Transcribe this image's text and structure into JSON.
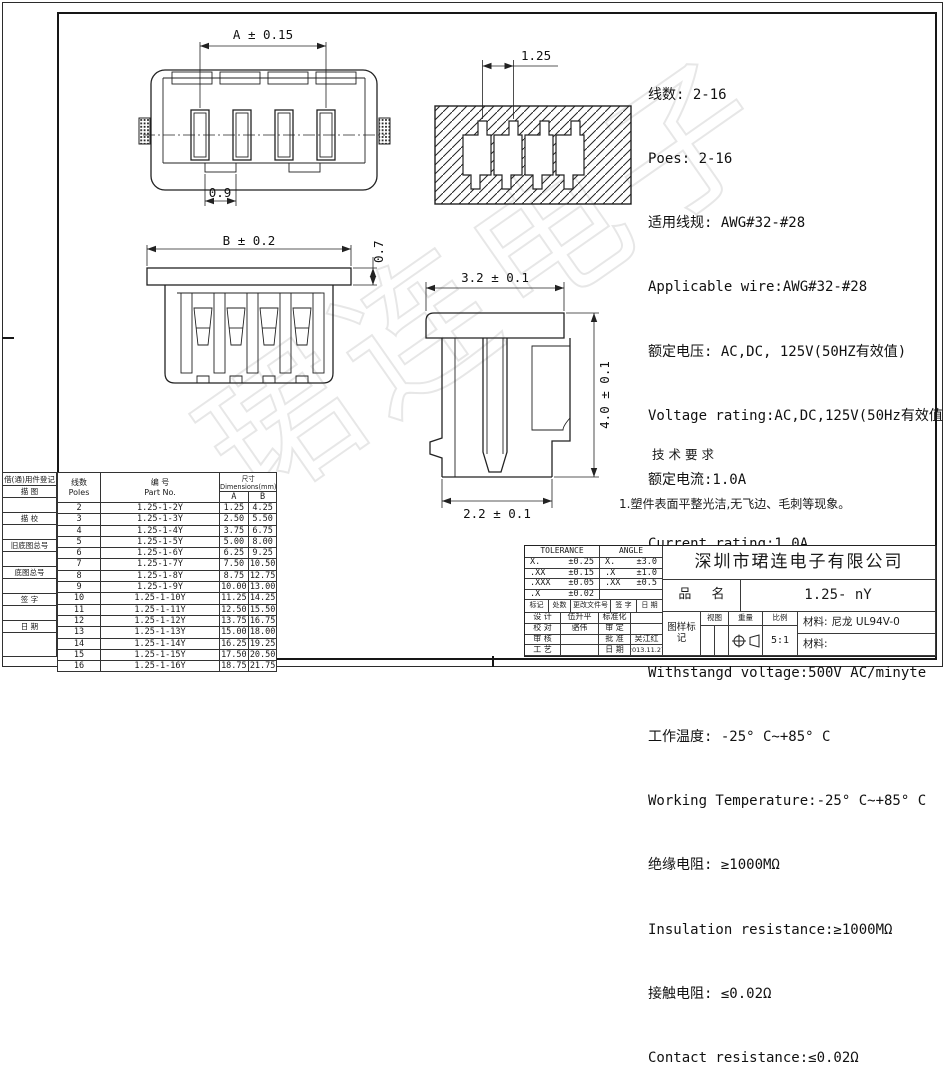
{
  "sheet": {
    "company": "深圳市珺连电子有限公司",
    "part_name_label": "品 名",
    "part_name": "1.25- nY",
    "scale": "5:1",
    "material1_label": "材料:",
    "material1_value": "尼龙 UL94V-0",
    "material2_label": "材料:",
    "watermark": "珺连电子"
  },
  "specs": {
    "lines": [
      "线数: 2-16",
      "Poes: 2-16",
      "适用线规: AWG#32-#28",
      "Applicable wire:AWG#32-#28",
      "额定电压: AC,DC, 125V(50HZ有效值)",
      "Voltage rating:AC,DC,125V(50Hz有效值)",
      "额定电流:1.0A",
      "Current rating:1.0A",
      "耐压值: 500V AC/minyte",
      "Withstangd voltage:500V AC/minyte",
      "工作温度: -25° C~+85° C",
      "Working Temperature:-25° C~+85° C",
      "绝缘电阻: ≥1000MΩ",
      "Insulation resistance:≥1000MΩ",
      "接触电阻: ≤0.02Ω",
      "Contact resistance:≤0.02Ω"
    ]
  },
  "tech": {
    "title": "技术要求",
    "items": [
      "1.塑件表面平整光洁,无飞边、毛刺等现象。",
      "2.未注尺寸公差按SJ1372-78中3级执行。",
      "3.相同规格的产品不同厂家应能互换。"
    ]
  },
  "dims": {
    "a": "A ± 0.15",
    "slot": "0.9",
    "pitch": "1.25",
    "b": "B ± 0.2",
    "flange": "0.7",
    "top_w": "3.2 ± 0.1",
    "height": "4.0 ± 0.1",
    "bottom_w": "2.2 ± 0.1"
  },
  "margin": {
    "header": "借(通)用件登记",
    "sections": [
      "描 图",
      "描 校",
      "旧底图总号",
      "底图总号",
      "签 字",
      "日 期"
    ]
  },
  "parts_table": {
    "col_poles_cn": "线数",
    "col_poles_en": "Poles",
    "col_part_cn": "编 号",
    "col_part_en": "Part No.",
    "col_dim": "尺寸Dimensions(mm)",
    "col_a": "A",
    "col_b": "B",
    "rows": [
      {
        "poles": "2",
        "part": "1.25-1-2Y",
        "a": "1.25",
        "b": "4.25"
      },
      {
        "poles": "3",
        "part": "1.25-1-3Y",
        "a": "2.50",
        "b": "5.50"
      },
      {
        "poles": "4",
        "part": "1.25-1-4Y",
        "a": "3.75",
        "b": "6.75"
      },
      {
        "poles": "5",
        "part": "1.25-1-5Y",
        "a": "5.00",
        "b": "8.00"
      },
      {
        "poles": "6",
        "part": "1.25-1-6Y",
        "a": "6.25",
        "b": "9.25"
      },
      {
        "poles": "7",
        "part": "1.25-1-7Y",
        "a": "7.50",
        "b": "10.50"
      },
      {
        "poles": "8",
        "part": "1.25-1-8Y",
        "a": "8.75",
        "b": "12.75"
      },
      {
        "poles": "9",
        "part": "1.25-1-9Y",
        "a": "10.00",
        "b": "13.00"
      },
      {
        "poles": "10",
        "part": "1.25-1-10Y",
        "a": "11.25",
        "b": "14.25"
      },
      {
        "poles": "11",
        "part": "1.25-1-11Y",
        "a": "12.50",
        "b": "15.50"
      },
      {
        "poles": "12",
        "part": "1.25-1-12Y",
        "a": "13.75",
        "b": "16.75"
      },
      {
        "poles": "13",
        "part": "1.25-1-13Y",
        "a": "15.00",
        "b": "18.00"
      },
      {
        "poles": "14",
        "part": "1.25-1-14Y",
        "a": "16.25",
        "b": "19.25"
      },
      {
        "poles": "15",
        "part": "1.25-1-15Y",
        "a": "17.50",
        "b": "20.50"
      },
      {
        "poles": "16",
        "part": "1.25-1-16Y",
        "a": "18.75",
        "b": "21.75"
      }
    ]
  },
  "title_block": {
    "tolerance_header": "TOLERANCE",
    "angle_header": "ANGLE",
    "tol_rows": [
      [
        "X.",
        "±0.25"
      ],
      [
        ".XX",
        "±0.15"
      ],
      [
        ".XXX",
        "±0.05"
      ],
      [
        ".X",
        "±0.02"
      ]
    ],
    "ang_rows": [
      [
        "X.",
        "±3.0"
      ],
      [
        ".X",
        "±1.0"
      ],
      [
        ".XX",
        "±0.5"
      ],
      [
        "",
        ""
      ]
    ],
    "rev_cols": [
      "标记",
      "处数",
      "更改文件号",
      "签 字",
      "日 期"
    ],
    "sign_rows": [
      [
        "设 计",
        "伍升平",
        "标准化",
        ""
      ],
      [
        "校 对",
        "骆伟",
        "审 定",
        ""
      ],
      [
        "审 核",
        "",
        "批 准",
        "吴江红"
      ],
      [
        "工 艺",
        "",
        "日 期",
        "2013.11.27"
      ]
    ],
    "stamp_headers": [
      "图样标记",
      "视图",
      "重量",
      "比例"
    ]
  }
}
